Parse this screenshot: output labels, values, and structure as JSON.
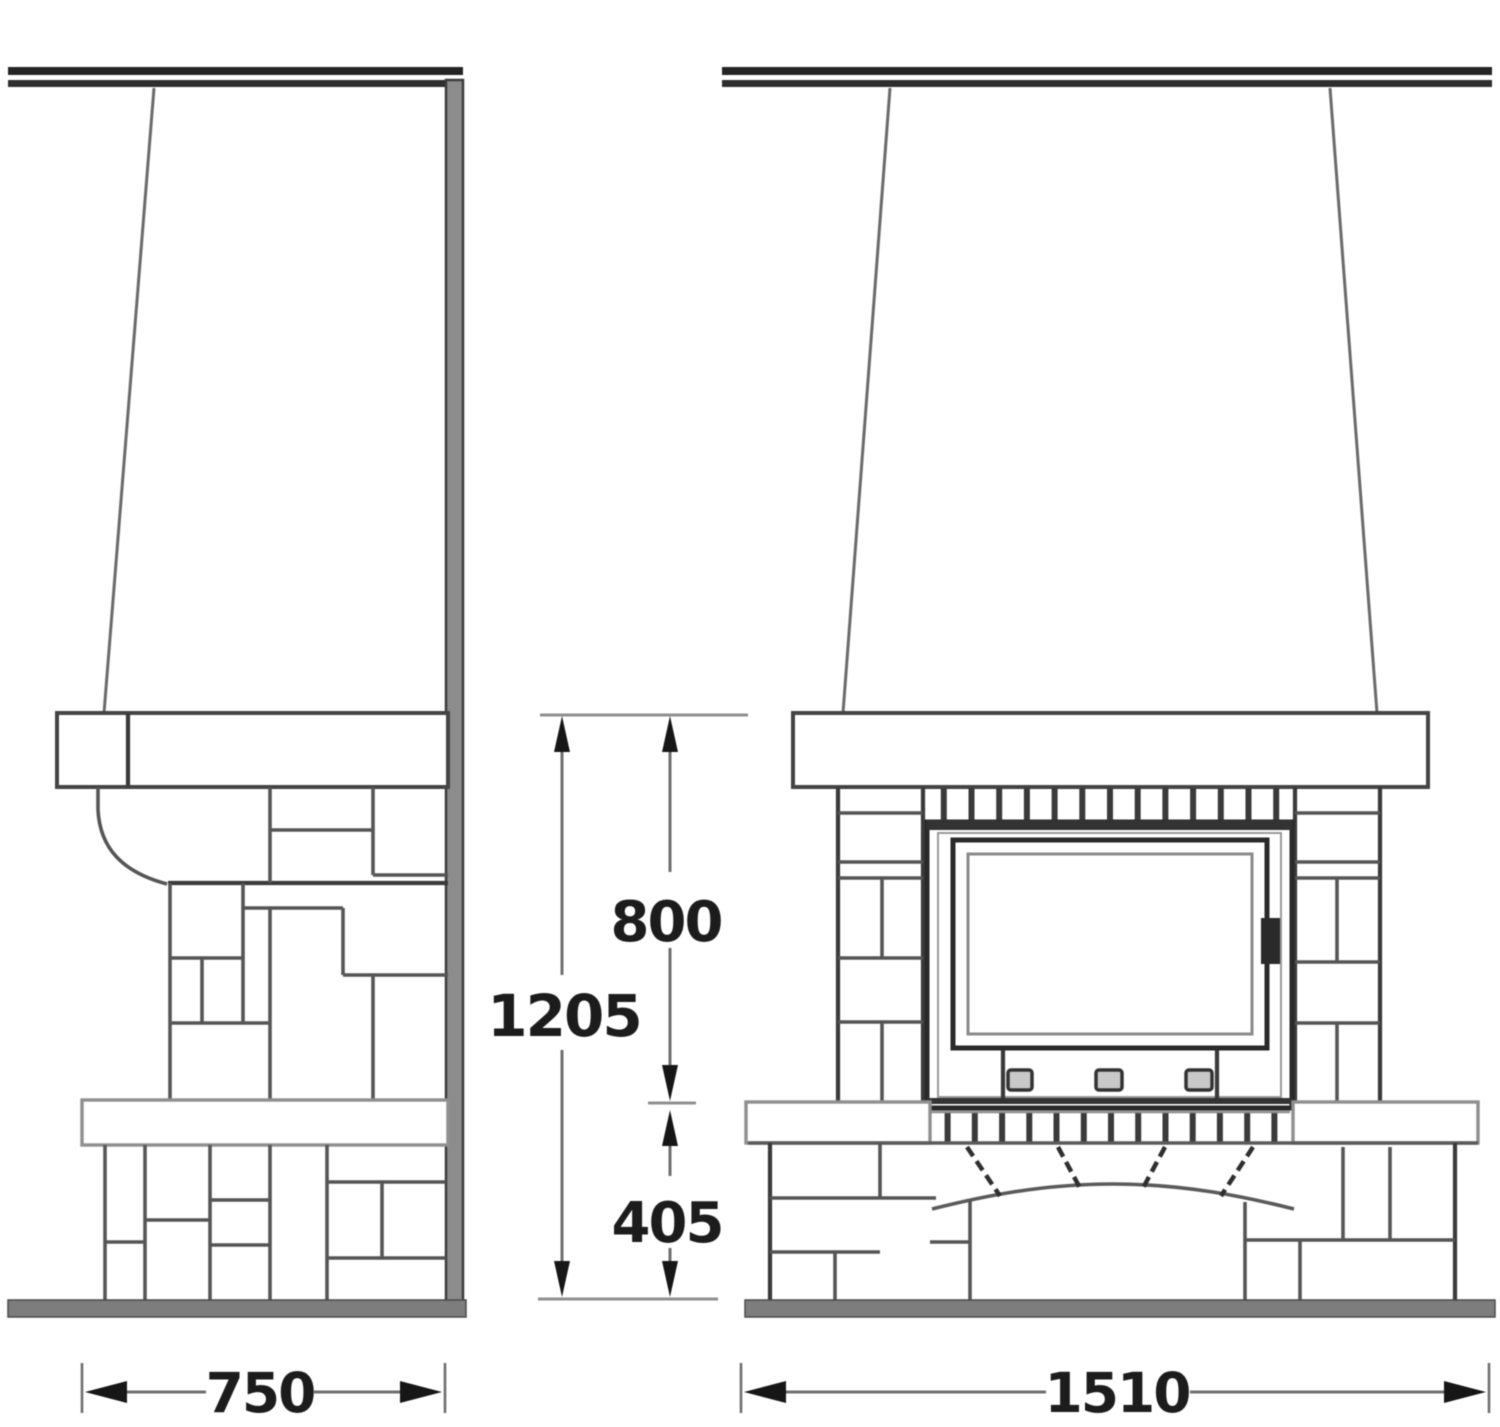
{
  "drawing": {
    "kind": "fireplace technical drawing, side and front elevation",
    "colors": {
      "paper": "#ffffff",
      "ink_dark": "#2b2b2b",
      "ink_medium": "#555555",
      "ink_light": "#8f8f8f",
      "wall_fill": "#8c8c8c",
      "floor_fill": "#7d7d7d"
    },
    "dimensions": {
      "side_width": {
        "label": "750"
      },
      "front_width": {
        "label": "1510"
      },
      "overall_height": {
        "label": "1205"
      },
      "upper_section_height": {
        "label": "800"
      },
      "bench_height": {
        "label": "405"
      }
    }
  }
}
